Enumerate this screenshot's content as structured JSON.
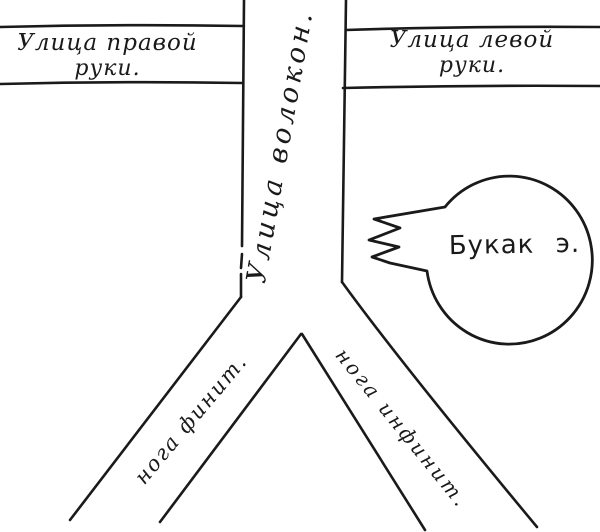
{
  "map": {
    "background_color": "#ffffff",
    "ink_color": "#1a1a1a",
    "labels": {
      "street_top_left": {
        "line1": "Улица правой",
        "line2": "руки."
      },
      "street_top_right": {
        "line1": "Улица левой",
        "line2": "руки."
      },
      "street_vertical": {
        "text": "Улица волокон."
      },
      "street_bottom_left": {
        "text": "нога финит."
      },
      "street_bottom_right": {
        "text": "нога инфинит."
      },
      "speech_bubble": {
        "text": "Букак э."
      }
    }
  }
}
